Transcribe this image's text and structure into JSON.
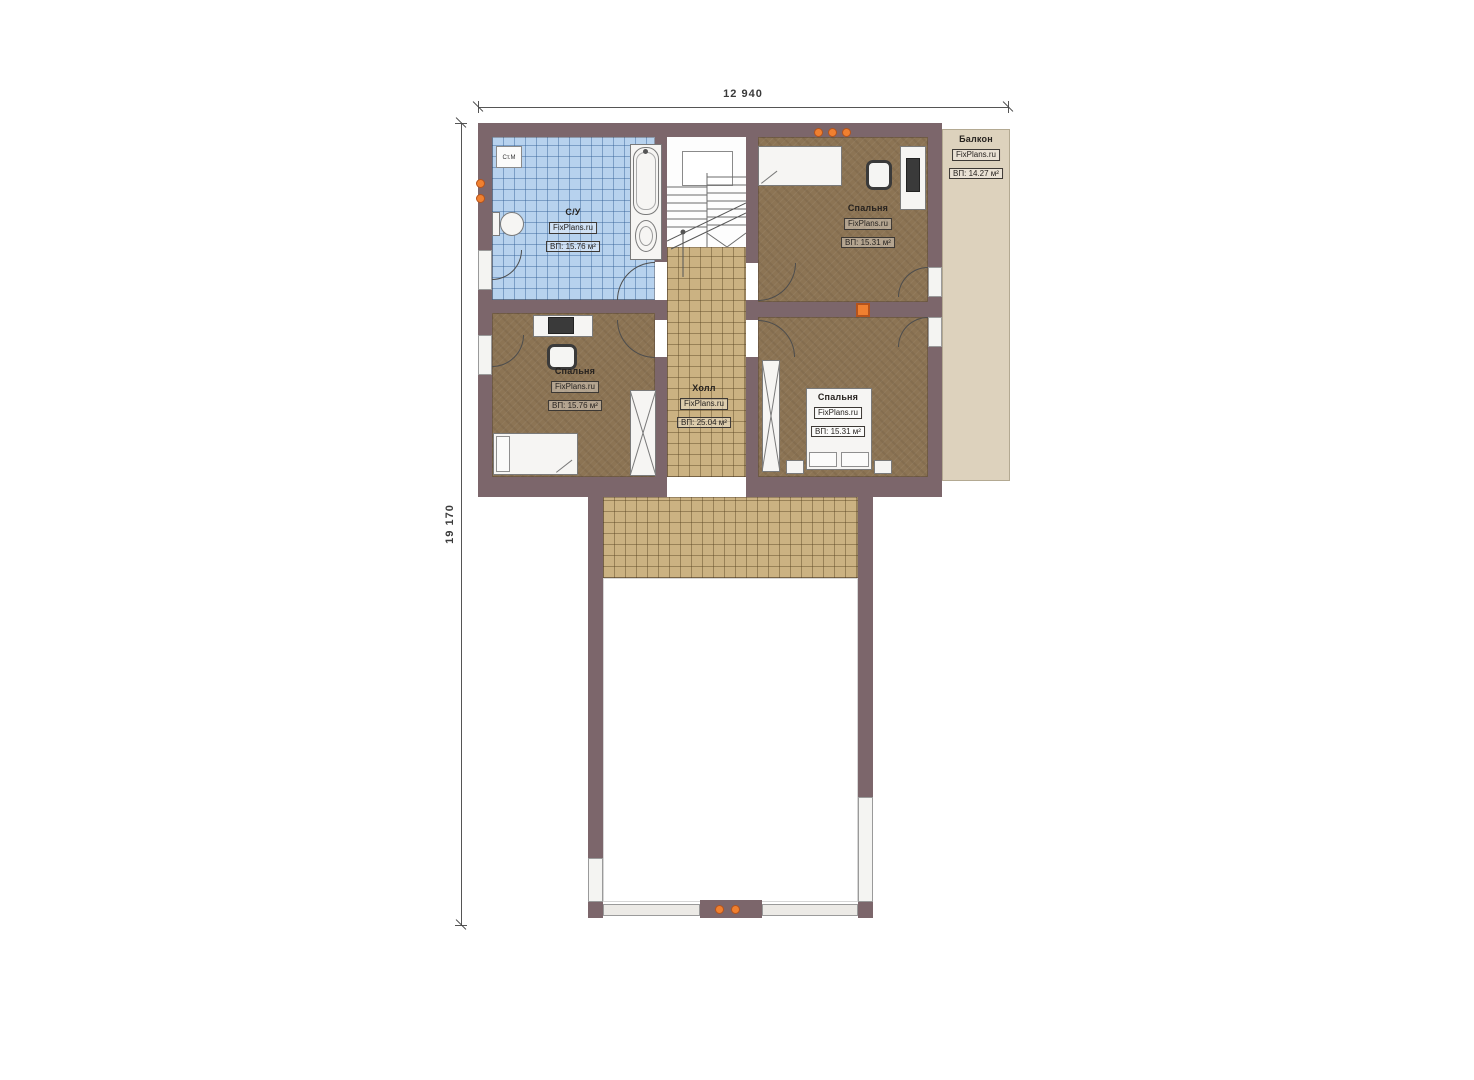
{
  "palette": {
    "wall": "#7c666b",
    "bedroom_floor": "#8c7454",
    "bathroom_floor": "#b7d2ee",
    "hall_tile": "#cbb282",
    "balcony_floor": "#ddd2bd",
    "accent_orange": "#f08030"
  },
  "dimensions": {
    "top": "12 940",
    "left": "19 170"
  },
  "rooms": {
    "bathroom": {
      "name": "С/У",
      "site": "FixPlans.ru",
      "area": "ВП: 15.76 м²"
    },
    "bedroom_top_right": {
      "name": "Спальня",
      "site": "FixPlans.ru",
      "area": "ВП: 15.31 м²"
    },
    "bedroom_bottom_left": {
      "name": "Спальня",
      "site": "FixPlans.ru",
      "area": "ВП: 15.76 м²"
    },
    "bedroom_bottom_right": {
      "name": "Спальня",
      "site": "FixPlans.ru",
      "area": "ВП: 15.31 м²"
    },
    "hall": {
      "name": "Холл",
      "site": "FixPlans.ru",
      "area": "ВП: 25.04 м²"
    },
    "balcony": {
      "name": "Балкон",
      "site": "FixPlans.ru",
      "area": "ВП: 14.27 м²"
    }
  },
  "tags": {
    "washing_machine": "Ст.М"
  }
}
